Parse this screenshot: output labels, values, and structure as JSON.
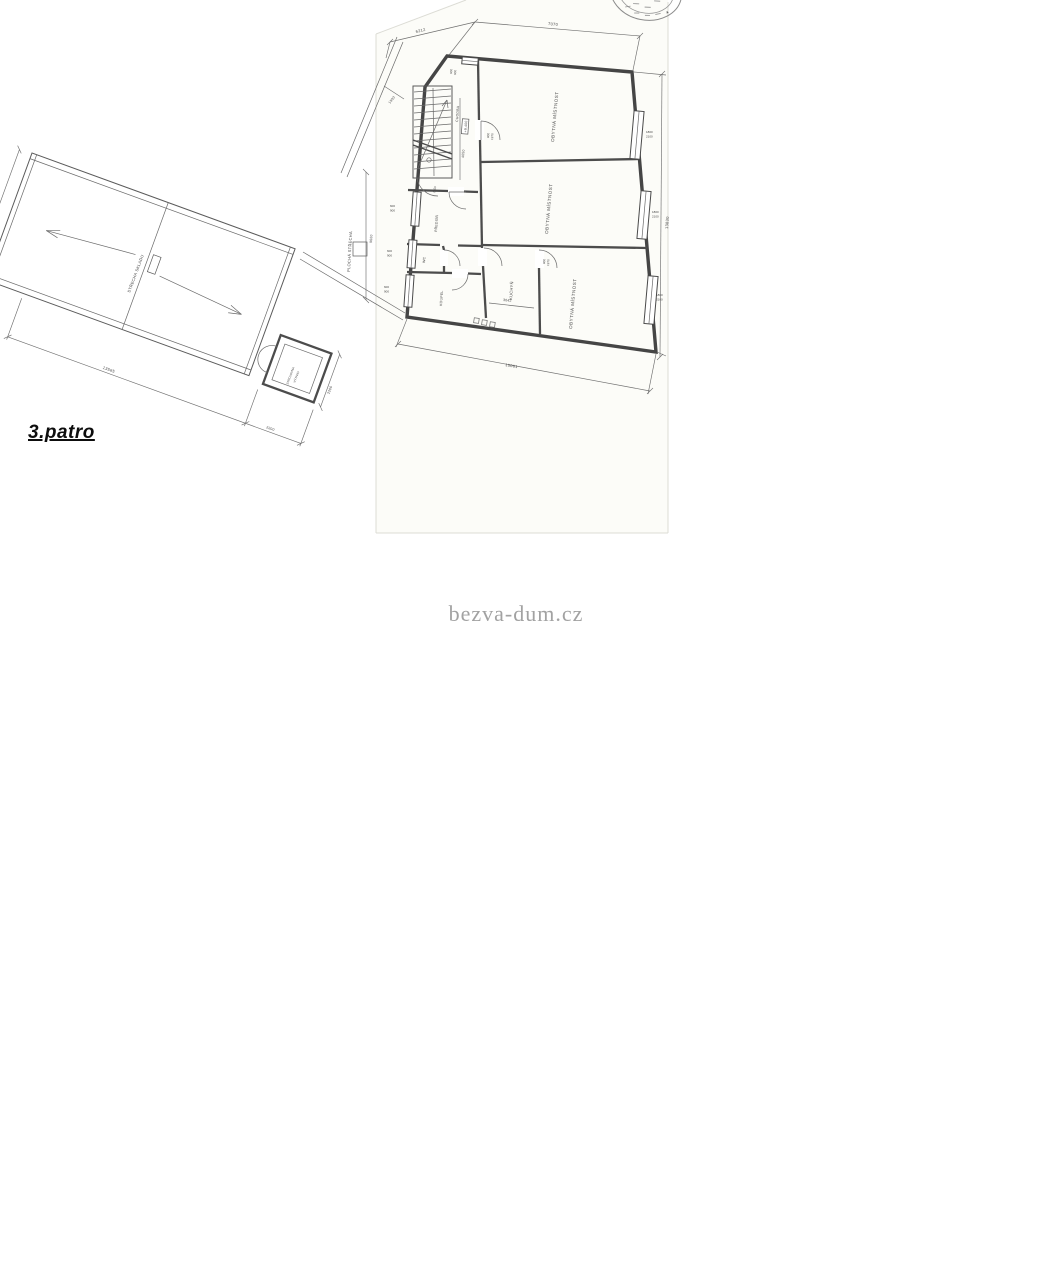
{
  "colors": {
    "ink": "#4a4a4a",
    "watermark_gray": "#a2a2a2",
    "label_black": "#0d0d0d",
    "paper": "#fcfcf8"
  },
  "page": {
    "floor_label": "3.patro",
    "watermark": "bezva-dum.cz"
  },
  "stamp": {
    "symbol": "*"
  },
  "floor_plan": {
    "rooms": {
      "corridor": "CHODBA",
      "hall": "PŘEDSÍŇ",
      "wc": "WC",
      "bath": "KOUPEL",
      "kitchen": "KUCHYŇ",
      "living_top": "OBYTNÁ MÍSTNOST",
      "living_mid": "OBYTNÁ MÍSTNOST",
      "living_bottom": "OBYTNÁ MÍSTNOST"
    },
    "level_mark": "+9,400",
    "dims": {
      "top_left": "6212",
      "top": "7070",
      "right_total": "13830",
      "bottom": "15061",
      "corridor": "4050",
      "stairs": "1750",
      "kitchen": "3042",
      "roof_strip": "9600",
      "strip_small": "1500"
    },
    "openings": {
      "door_w": "800",
      "door_h": "1970",
      "win_top_w": "600",
      "win_top_h": "600",
      "win_left_w": "600",
      "win_left_h": "900",
      "win_right_w": "1800",
      "win_right_h": "2100"
    }
  },
  "roof_plan": {
    "label": "STŘECHA SKLADU",
    "flat_roof_label": "PLOCHÁ STŘECHA",
    "elevator_line1": "STROJOVNA",
    "elevator_line2": "VÝTAHU",
    "dims": {
      "left": "5800",
      "bottom": "13565",
      "elevator": "2200"
    }
  }
}
